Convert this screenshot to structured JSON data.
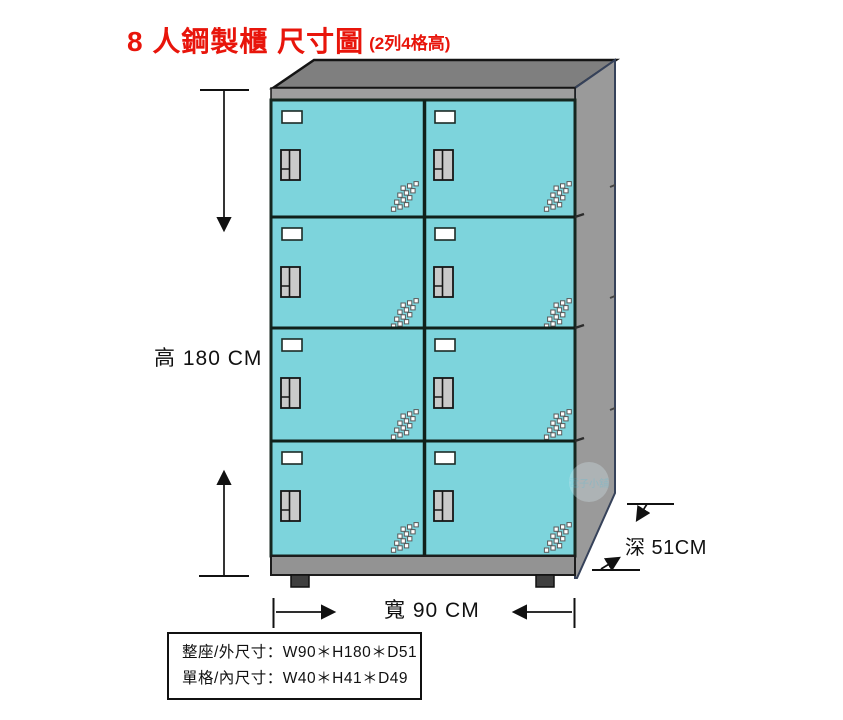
{
  "title": {
    "main": "8 人鋼製櫃 尺寸圖",
    "sub": "(2列4格高)"
  },
  "annotations": {
    "height_label": "高 180 CM",
    "width_label": "寬 90 CM",
    "depth_label": "深 51CM"
  },
  "spec_box": {
    "line1": "整座/外尺寸：W90＊H180＊D51",
    "line2": "單格/內尺寸：W40＊H41＊D49"
  },
  "locker": {
    "rows": 4,
    "columns": 2,
    "compartments": 8,
    "door_color": "#7dd4dc",
    "frame_color": "#15261f",
    "top_color": "#7f7f7f",
    "rail_color": "#9e9e9e",
    "side_color": "#9a9a9a",
    "base_color": "#939393",
    "foot_color": "#3f3f3f",
    "handle_color": "#c9c9c9",
    "card_color": "#ffffff"
  },
  "watermark": {
    "text": "電子小舖"
  },
  "colors": {
    "title": "#e8150b",
    "text": "#111111",
    "background": "#ffffff"
  }
}
